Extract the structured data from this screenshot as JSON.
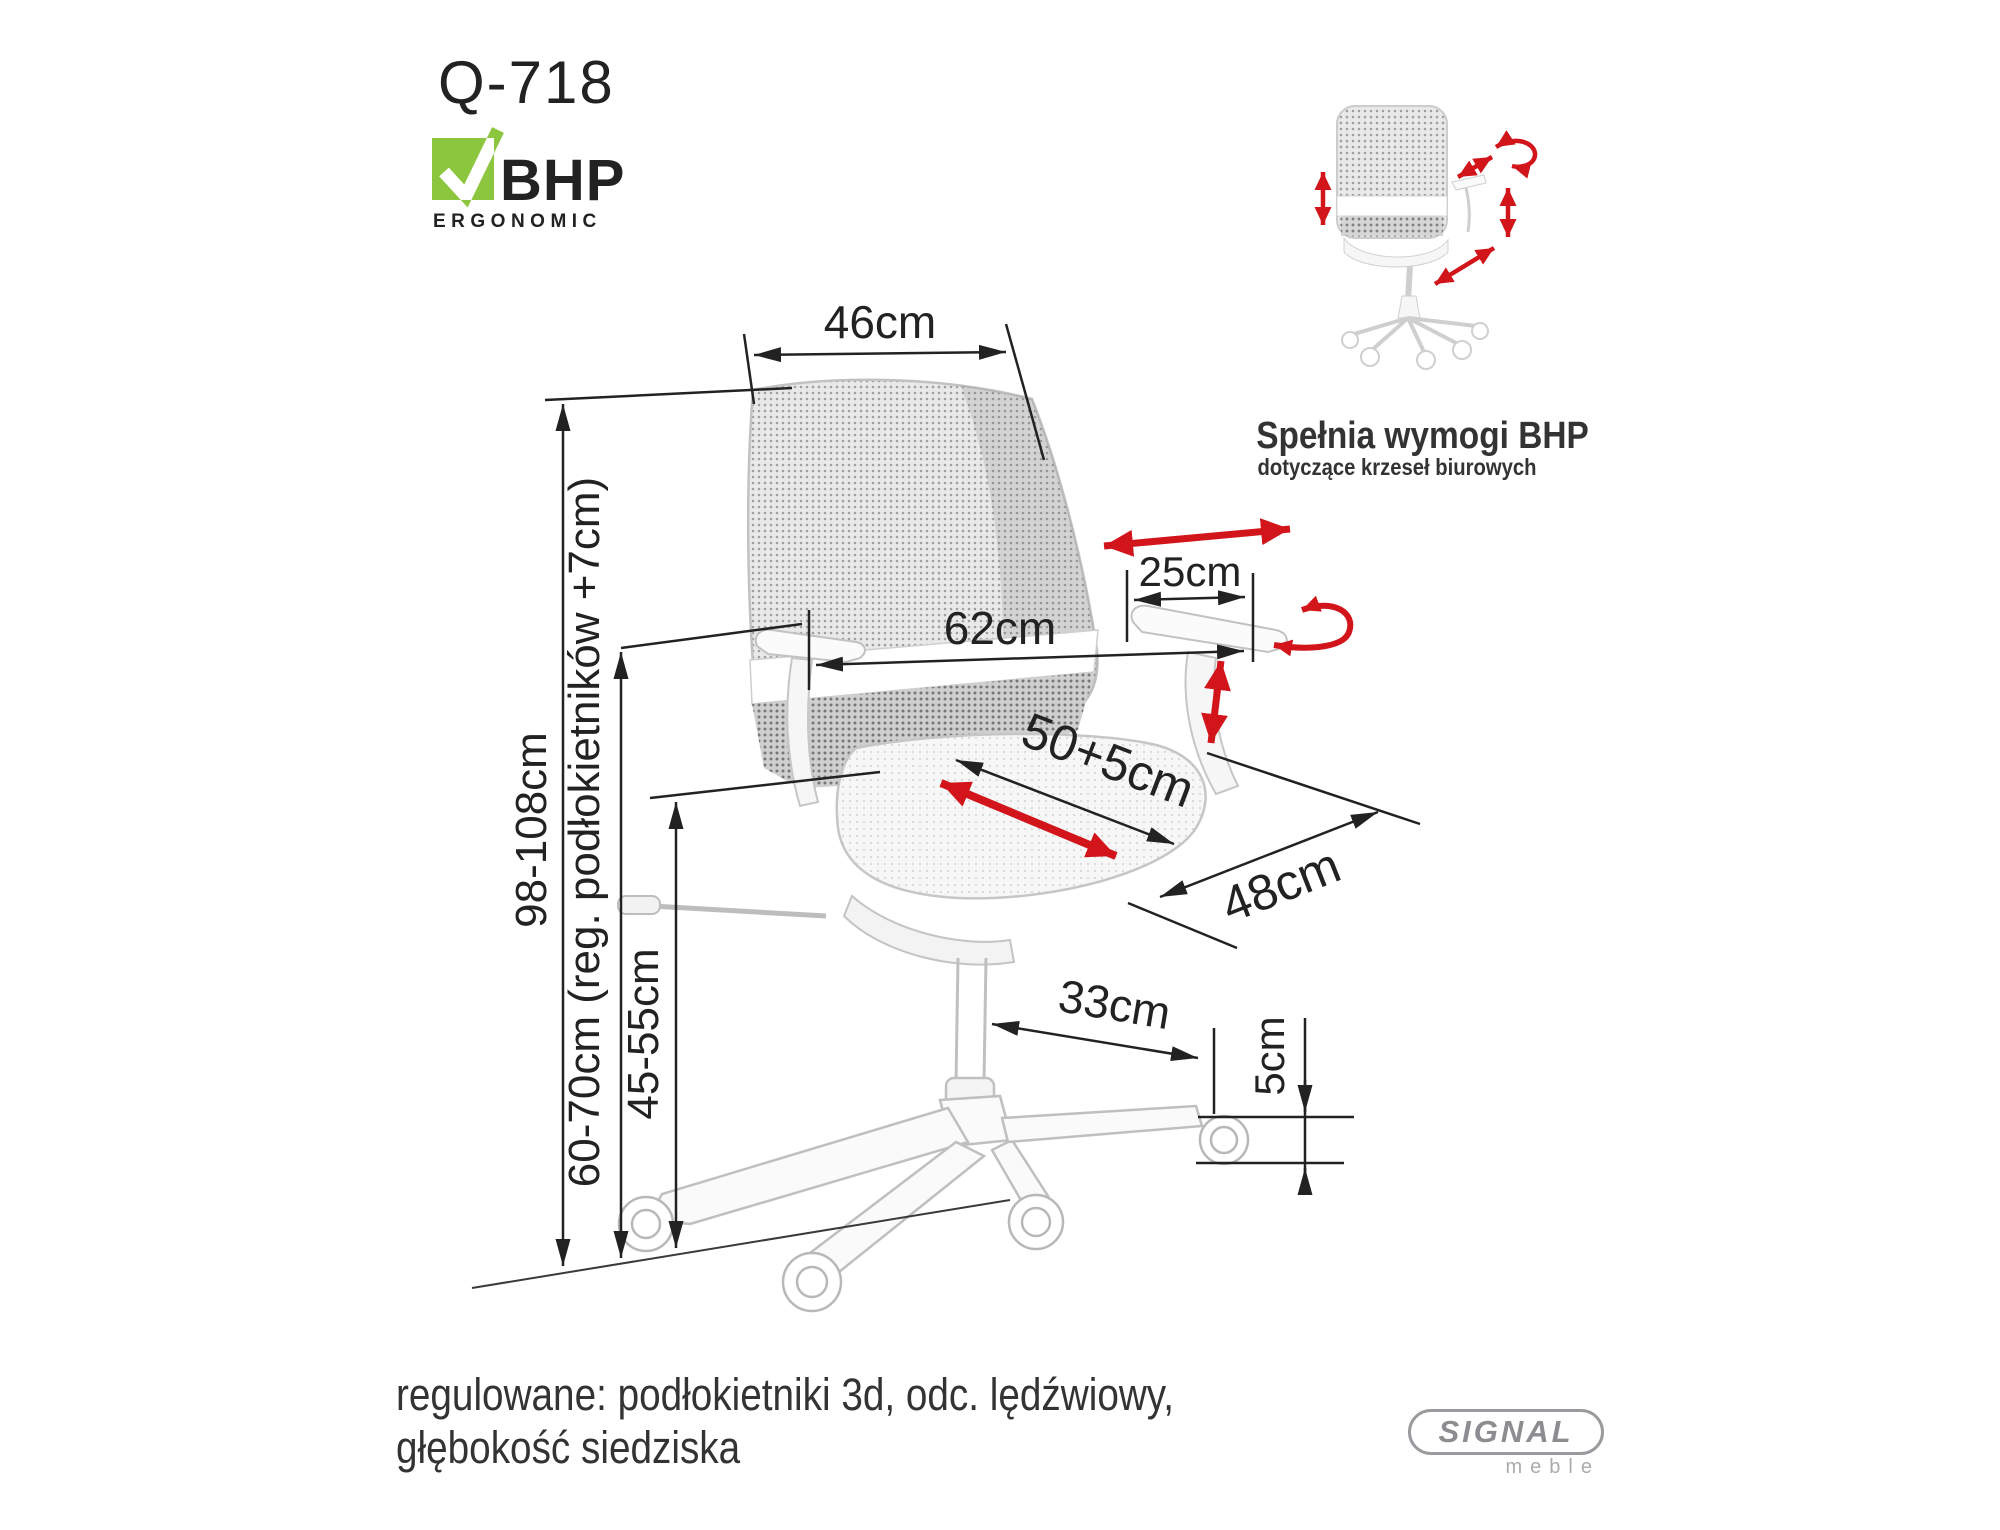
{
  "title": {
    "model": "Q-718"
  },
  "bhp_logo": {
    "name": "BHP",
    "subtitle": "ERGONOMIC"
  },
  "badge": {
    "title": "Spełnia wymogi BHP",
    "subtitle": "dotyczące krzeseł biurowych"
  },
  "dimensions": {
    "back_width": "46cm",
    "total_height": "98-108cm",
    "armrest_height": "60-70cm (reg. podłokietników +7cm)",
    "seat_height": "45-55cm",
    "overall_width": "62cm",
    "armrest_pad_length": "25cm",
    "seat_depth": "50+5cm",
    "seat_width": "48cm",
    "base_arm_length": "33cm",
    "caster_height": "5cm"
  },
  "footer": {
    "line1": "regulowane: podłokietniki 3d, odc. lędźwiowy,",
    "line2": "głębokość siedziska"
  },
  "brand": {
    "name": "SIGNAL",
    "subtitle": "meble"
  },
  "colors": {
    "accent_red": "#d2151b",
    "logo_green": "#8cc63e",
    "logo_blue": "#2d74b6",
    "brand_gray": "#8d8d91",
    "dimension_line": "#222222"
  }
}
